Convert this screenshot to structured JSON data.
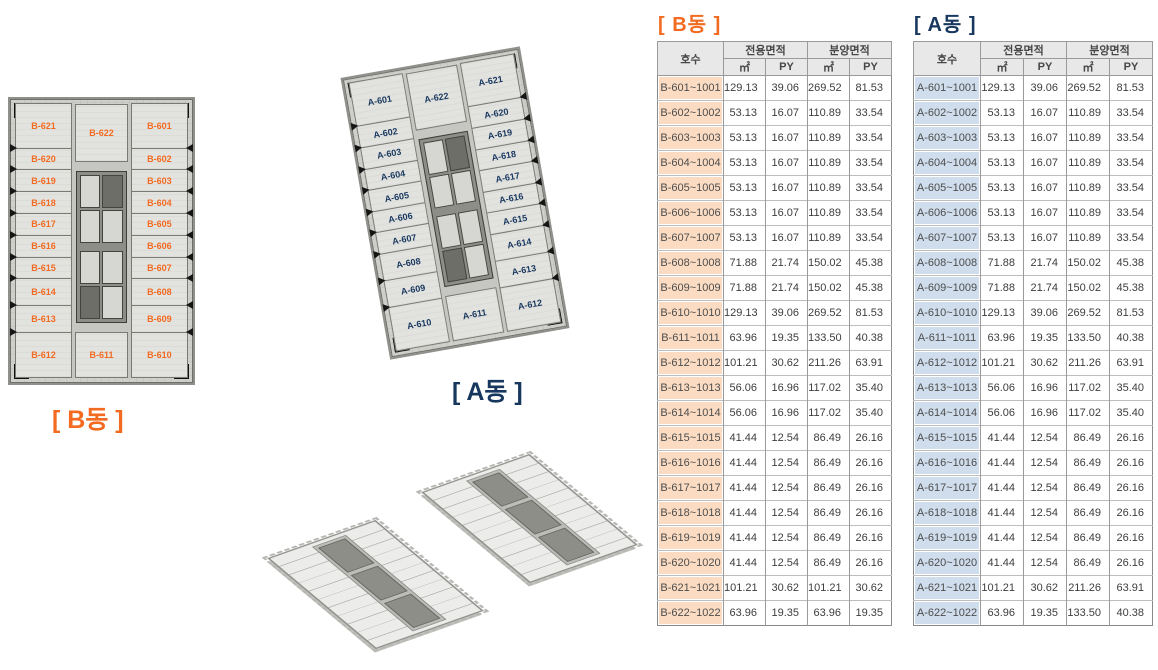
{
  "colors": {
    "accent_orange": "#F26B21",
    "accent_navy": "#17375E",
    "b_row_bg": "#FBDCC3",
    "a_row_bg": "#CFDDEC",
    "header_bg": "#E8E8E8"
  },
  "headers": {
    "unit": "호수",
    "exclusive": "전용면적",
    "supply": "분양면적",
    "sqm": "㎡",
    "py": "PY"
  },
  "plan_b": {
    "caption": "[ B동 ]",
    "top_center_unit": "B-622",
    "bottom_center_unit": "B-611",
    "left_units": [
      "B-621",
      "B-620",
      "B-619",
      "B-618",
      "B-617",
      "B-616",
      "B-615",
      "B-614",
      "B-613",
      "B-612"
    ],
    "right_units": [
      "B-601",
      "B-602",
      "B-603",
      "B-604",
      "B-605",
      "B-606",
      "B-607",
      "B-608",
      "B-609",
      "B-610"
    ]
  },
  "plan_a": {
    "caption": "[ A동 ]",
    "top_center_unit": "A-622",
    "bottom_center_unit": "A-611",
    "left_units": [
      "A-601",
      "A-602",
      "A-603",
      "A-604",
      "A-605",
      "A-606",
      "A-607",
      "A-608",
      "A-609",
      "A-610"
    ],
    "right_units": [
      "A-621",
      "A-620",
      "A-619",
      "A-618",
      "A-617",
      "A-616",
      "A-615",
      "A-614",
      "A-613",
      "A-612"
    ]
  },
  "table_b": {
    "title": "[ B동 ]",
    "rows": [
      [
        "B-601~1001",
        "129.13",
        "39.06",
        "269.52",
        "81.53"
      ],
      [
        "B-602~1002",
        "53.13",
        "16.07",
        "110.89",
        "33.54"
      ],
      [
        "B-603~1003",
        "53.13",
        "16.07",
        "110.89",
        "33.54"
      ],
      [
        "B-604~1004",
        "53.13",
        "16.07",
        "110.89",
        "33.54"
      ],
      [
        "B-605~1005",
        "53.13",
        "16.07",
        "110.89",
        "33.54"
      ],
      [
        "B-606~1006",
        "53.13",
        "16.07",
        "110.89",
        "33.54"
      ],
      [
        "B-607~1007",
        "53.13",
        "16.07",
        "110.89",
        "33.54"
      ],
      [
        "B-608~1008",
        "71.88",
        "21.74",
        "150.02",
        "45.38"
      ],
      [
        "B-609~1009",
        "71.88",
        "21.74",
        "150.02",
        "45.38"
      ],
      [
        "B-610~1010",
        "129.13",
        "39.06",
        "269.52",
        "81.53"
      ],
      [
        "B-611~1011",
        "63.96",
        "19.35",
        "133.50",
        "40.38"
      ],
      [
        "B-612~1012",
        "101.21",
        "30.62",
        "211.26",
        "63.91"
      ],
      [
        "B-613~1013",
        "56.06",
        "16.96",
        "117.02",
        "35.40"
      ],
      [
        "B-614~1014",
        "56.06",
        "16.96",
        "117.02",
        "35.40"
      ],
      [
        "B-615~1015",
        "41.44",
        "12.54",
        "86.49",
        "26.16"
      ],
      [
        "B-616~1016",
        "41.44",
        "12.54",
        "86.49",
        "26.16"
      ],
      [
        "B-617~1017",
        "41.44",
        "12.54",
        "86.49",
        "26.16"
      ],
      [
        "B-618~1018",
        "41.44",
        "12.54",
        "86.49",
        "26.16"
      ],
      [
        "B-619~1019",
        "41.44",
        "12.54",
        "86.49",
        "26.16"
      ],
      [
        "B-620~1020",
        "41.44",
        "12.54",
        "86.49",
        "26.16"
      ],
      [
        "B-621~1021",
        "101.21",
        "30.62",
        "101.21",
        "30.62"
      ],
      [
        "B-622~1022",
        "63.96",
        "19.35",
        "63.96",
        "19.35"
      ]
    ]
  },
  "table_a": {
    "title": "[ A동 ]",
    "rows": [
      [
        "A-601~1001",
        "129.13",
        "39.06",
        "269.52",
        "81.53"
      ],
      [
        "A-602~1002",
        "53.13",
        "16.07",
        "110.89",
        "33.54"
      ],
      [
        "A-603~1003",
        "53.13",
        "16.07",
        "110.89",
        "33.54"
      ],
      [
        "A-604~1004",
        "53.13",
        "16.07",
        "110.89",
        "33.54"
      ],
      [
        "A-605~1005",
        "53.13",
        "16.07",
        "110.89",
        "33.54"
      ],
      [
        "A-606~1006",
        "53.13",
        "16.07",
        "110.89",
        "33.54"
      ],
      [
        "A-607~1007",
        "53.13",
        "16.07",
        "110.89",
        "33.54"
      ],
      [
        "A-608~1008",
        "71.88",
        "21.74",
        "150.02",
        "45.38"
      ],
      [
        "A-609~1009",
        "71.88",
        "21.74",
        "150.02",
        "45.38"
      ],
      [
        "A-610~1010",
        "129.13",
        "39.06",
        "269.52",
        "81.53"
      ],
      [
        "A-611~1011",
        "63.96",
        "19.35",
        "133.50",
        "40.38"
      ],
      [
        "A-612~1012",
        "101.21",
        "30.62",
        "211.26",
        "63.91"
      ],
      [
        "A-613~1013",
        "56.06",
        "16.96",
        "117.02",
        "35.40"
      ],
      [
        "A-614~1014",
        "56.06",
        "16.96",
        "117.02",
        "35.40"
      ],
      [
        "A-615~1015",
        "41.44",
        "12.54",
        "86.49",
        "26.16"
      ],
      [
        "A-616~1016",
        "41.44",
        "12.54",
        "86.49",
        "26.16"
      ],
      [
        "A-617~1017",
        "41.44",
        "12.54",
        "86.49",
        "26.16"
      ],
      [
        "A-618~1018",
        "41.44",
        "12.54",
        "86.49",
        "26.16"
      ],
      [
        "A-619~1019",
        "41.44",
        "12.54",
        "86.49",
        "26.16"
      ],
      [
        "A-620~1020",
        "41.44",
        "12.54",
        "86.49",
        "26.16"
      ],
      [
        "A-621~1021",
        "101.21",
        "30.62",
        "211.26",
        "63.91"
      ],
      [
        "A-622~1022",
        "63.96",
        "19.35",
        "133.50",
        "40.38"
      ]
    ]
  }
}
